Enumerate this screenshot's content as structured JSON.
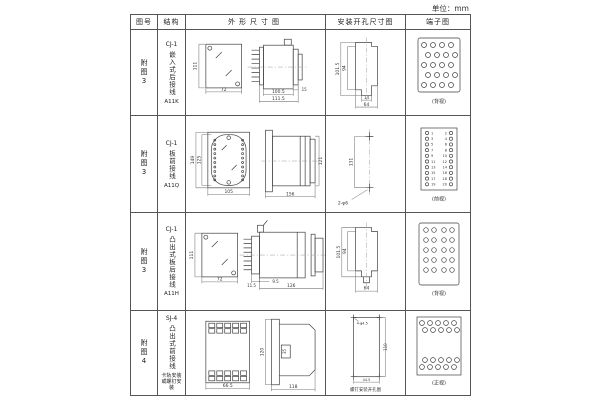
{
  "unit_label": "单位：mm",
  "table": {
    "headers": {
      "fig_no": "图号",
      "structure": "结构",
      "outline": "外形尺寸图",
      "install": "安装开孔尺寸图",
      "terminal": "端子图"
    },
    "rows": [
      {
        "fig_no": "附图3",
        "model": "CJ-1",
        "structure_desc": "嵌入式后接线",
        "code": "A11K",
        "outline": {
          "front_height": "111",
          "front_width": "72",
          "side_body": "100.5",
          "side_total": "111.5",
          "side_flange": "15"
        },
        "install": {
          "height_outer": "101.5",
          "height_inner": "94",
          "bottom_small": "14",
          "bottom_width": "64"
        },
        "terminal": {
          "view_label": "(背视)"
        }
      },
      {
        "fig_no": "附图3",
        "model": "CJ-1",
        "structure_desc": "板前接线",
        "code": "A11Q",
        "outline": {
          "front_height_outer": "149",
          "front_height_inner": "125",
          "front_width": "105",
          "side_width": "156",
          "side_height": "121"
        },
        "install": {
          "hole_spacing": "131",
          "hole_spec": "2-φ6"
        },
        "terminal": {
          "view_label": "(前视)",
          "left_numbers": [
            "1",
            "3",
            "5",
            "7",
            "9",
            "11",
            "13",
            "15",
            "17",
            "19"
          ],
          "right_numbers": [
            "2",
            "4",
            "6",
            "8",
            "10",
            "12",
            "14",
            "16",
            "18",
            "20"
          ]
        }
      },
      {
        "fig_no": "附图3",
        "model": "CJ-1",
        "structure_desc": "凸出式板后接线",
        "code": "A11H",
        "outline": {
          "front_height": "111",
          "front_width": "72",
          "pin_depth": "11.5",
          "panel_gap": "9.5",
          "side_total": "126"
        },
        "install": {
          "height_outer": "101.5",
          "height_inner": "94",
          "bottom_width": "64"
        },
        "terminal": {
          "view_label": "(背视)"
        }
      },
      {
        "fig_no": "附图4",
        "model": "SJ-4",
        "structure_desc": "凸出式前接线",
        "mount_note": "卡轨安装或螺钉安装",
        "outline": {
          "front_width": "66.5",
          "side_height": "120",
          "side_inner": "35",
          "side_width": "118"
        },
        "install": {
          "hole_spec": "4-φ4.5",
          "height": "110",
          "bottom_width": "44.5",
          "note": "螺钉安装开孔图"
        },
        "terminal": {
          "view_label": "(正视)"
        }
      }
    ]
  }
}
